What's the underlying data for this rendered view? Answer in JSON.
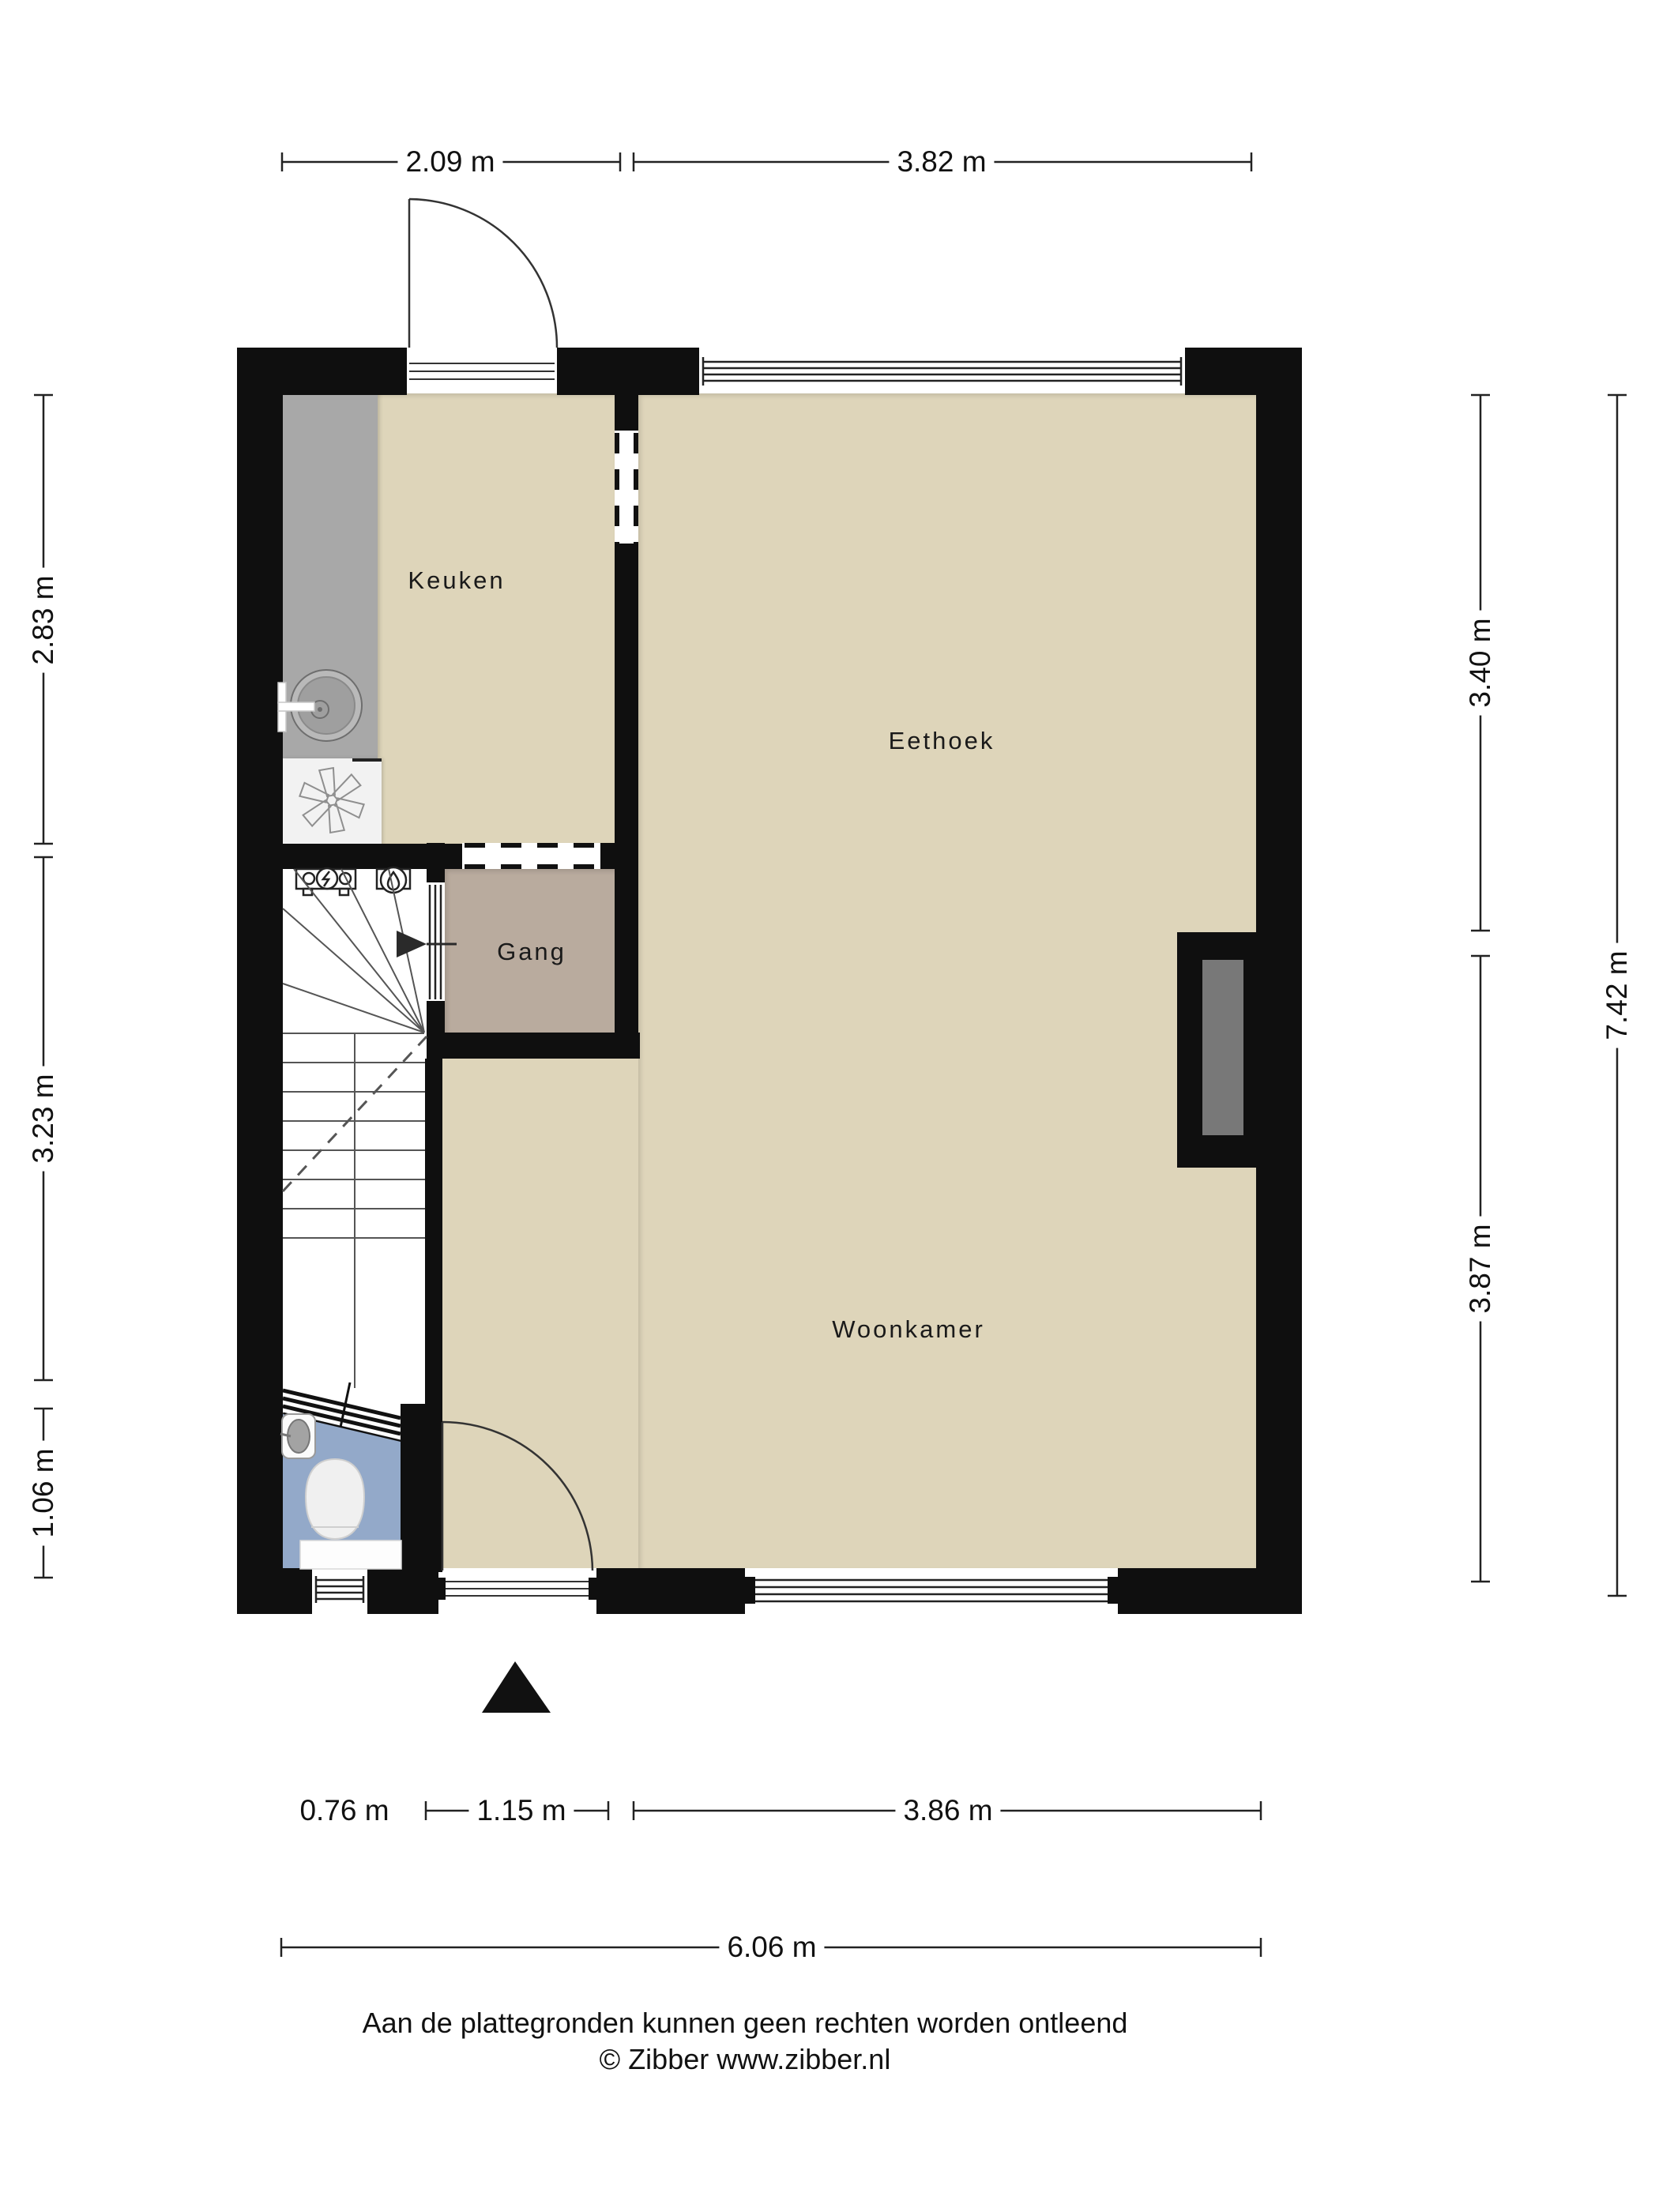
{
  "plan": {
    "rooms": [
      {
        "id": "keuken",
        "label": "Keuken"
      },
      {
        "id": "eethoek",
        "label": "Eethoek"
      },
      {
        "id": "gang",
        "label": "Gang"
      },
      {
        "id": "woonkamer",
        "label": "Woonkamer"
      }
    ],
    "fixtures": [
      "kitchen-counter",
      "kitchen-sink",
      "kitchen-faucet",
      "boiler-asterisk",
      "electric-meter",
      "water-meter",
      "winder-staircase",
      "stair-direction-arrow",
      "toilet-bowl",
      "toilet-sink",
      "chimney-breast",
      "entrance-door",
      "living-room-door",
      "hall-door-opening",
      "pass-through-opening",
      "top-window",
      "bottom-window-large",
      "bottom-window-small",
      "north-arrow"
    ]
  },
  "dimensions": {
    "top": [
      {
        "label": "2.09 m"
      },
      {
        "label": "3.82 m"
      }
    ],
    "left": [
      {
        "label": "2.83 m"
      },
      {
        "label": "3.23 m"
      },
      {
        "label": "1.06 m"
      }
    ],
    "right_inner": [
      {
        "label": "3.40 m"
      },
      {
        "label": "3.87 m"
      }
    ],
    "right_outer": [
      {
        "label": "7.42 m"
      }
    ],
    "bottom_inner": [
      {
        "label": "0.76 m"
      },
      {
        "label": "1.15 m"
      },
      {
        "label": "3.86 m"
      }
    ],
    "bottom_outer": [
      {
        "label": "6.06 m"
      }
    ]
  },
  "footer": {
    "disclaimer": "Aan de plattegronden kunnen geen rechten worden ontleend",
    "credit": "© Zibber www.zibber.nl"
  },
  "colors": {
    "wall": "#0f0f0f",
    "floor": "#ded5ba",
    "hall-floor": "#b9ab9e",
    "toilet-floor": "#93a9c9",
    "counter": "#a8a8a8",
    "chimney": "#787878",
    "line": "#2a2a2a",
    "paper": "#ffffff"
  }
}
